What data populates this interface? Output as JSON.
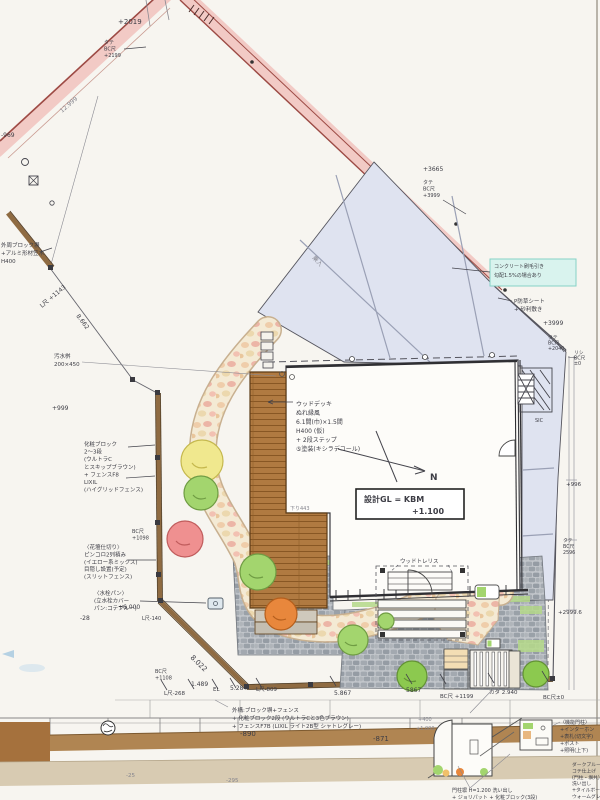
{
  "drawing_type": "landscape-exterior-site-plan",
  "colors": {
    "paper": "#f7f5f0",
    "road_pink": "#f2c3be",
    "boundary_red": "#9c4a44",
    "driveway_blue": "#dfe3f0",
    "deck_brown": "#b07a41",
    "fence_brown": "#8f6b42",
    "cobble_grey": "#aab0b6",
    "path_beige": "#f4ead4",
    "tree_yellow": "#f0e88e",
    "tree_green": "#a3d56e",
    "tree_red": "#ef9090",
    "tree_orange": "#e8873c",
    "highlight_cyan": "#d9f3ee",
    "ink": "#3d3d45"
  },
  "labels": {
    "top": {
      "plus2019": "+2019",
      "pole_block": [
        "タテ",
        "BC尺",
        "+2199"
      ],
      "road_width": "12.999",
      "minus969": "-969"
    },
    "ne": {
      "plus3665": "+3665",
      "pole_block": [
        "タテ",
        "BC尺",
        "+3999"
      ],
      "concrete_note": [
        "コンクリート刷毛引き",
        "勾配1.5%の場合あり"
      ],
      "weed_note": [
        "P防草シート",
        "+ 砂利敷き"
      ],
      "plus3999": "+3999",
      "corner_a": [
        "タテ",
        "BC尺",
        "+2040"
      ],
      "corner_b": [
        "リシ",
        "BC尺",
        "±0"
      ],
      "drive_label": "乗入"
    },
    "left": {
      "wall_note": [
        "外周ブロック塀",
        "+アルミ形材笠木",
        "H400"
      ],
      "lr1143": "L尺 +1143",
      "dim8662": "8.662",
      "plus999": "+999",
      "sewer_note": [
        "汚水桝",
        "200×450"
      ],
      "block_note": [
        "化粧ブロック",
        "2〜3段",
        "(ウルトラC",
        "とスキップブラウン)",
        "+ フェンスF8",
        "LIXIL",
        "(ハイグリッドフェンス)"
      ],
      "bcr1098": [
        "BC尺",
        "+1098"
      ],
      "bed_note": [
        "〈花壇仕切り〉",
        "ピンコロ2列積み",
        "(イエロー系ミックス)",
        "目隠し設置(予定)",
        "(スリットフェンス)"
      ],
      "tap_note": [
        "〈水栓パン〉",
        "(立水栓カバー",
        "パン:コテブルー)"
      ],
      "plus6000": "+6.000",
      "minus28": "-28",
      "lr140": "L尺-140",
      "dim8022": "8.022"
    },
    "plan": {
      "deck_note": [
        "ウッドデッキ",
        "ぬれ縁風",
        "6.1間(巾)×1.5間",
        "H400 (仮)",
        "+ 2段ステップ",
        "⑤塗装(キシラデコール)"
      ],
      "gl_line1": "設計GL = KBM",
      "gl_line2": "+1.100",
      "north": "N",
      "sic": "SIC",
      "step_down": "下り443",
      "trellis": "ウッドトレリス"
    },
    "dims": {
      "bc1108": [
        "BC尺",
        "+1108"
      ],
      "lr268": "L尺-268",
      "d1489": "1.489",
      "el": "EL",
      "d5284": "5.284",
      "lr809": "L尺-809",
      "d5867a": "5.867",
      "d5867b": "5867",
      "bcr1199": "BC尺 +1199",
      "kata2940": "カタ 2.940",
      "bcr0": "BC尺±0"
    },
    "right": {
      "plus996": "+996",
      "bcr2596": [
        "タテ",
        "BC尺",
        "2596"
      ],
      "plus2999": "+2999.6"
    },
    "section": {
      "minus890": "-890",
      "minus871": "-871",
      "minus25": "-25",
      "minus295": "-295",
      "plus400": "+400",
      "plus1000": "+1.000",
      "fence_note": [
        "外構:ブロック塀+フェンス",
        "+ 化粧ブロック2段 (ウルトラCと3色ブラウン)",
        "+ フェンスF7B (LIXIL ライト2B型 シャトレグレー)"
      ],
      "pillar_list": [
        "〈機能門柱〉",
        "+インターホン",
        "+表札(切文字)",
        "+ポスト",
        "+照明(上下)"
      ],
      "finish_note": [
        "ダークブルー",
        "コテ仕上げ",
        "(門柱・塀共)",
        "洗い出し",
        "+タイルボーダー",
        "ウォームグレー"
      ],
      "gate_note": [
        "門柱塀 H=1.200 洗い出し",
        "+ ジョリパット + 化粧ブロック(3段)"
      ]
    }
  }
}
